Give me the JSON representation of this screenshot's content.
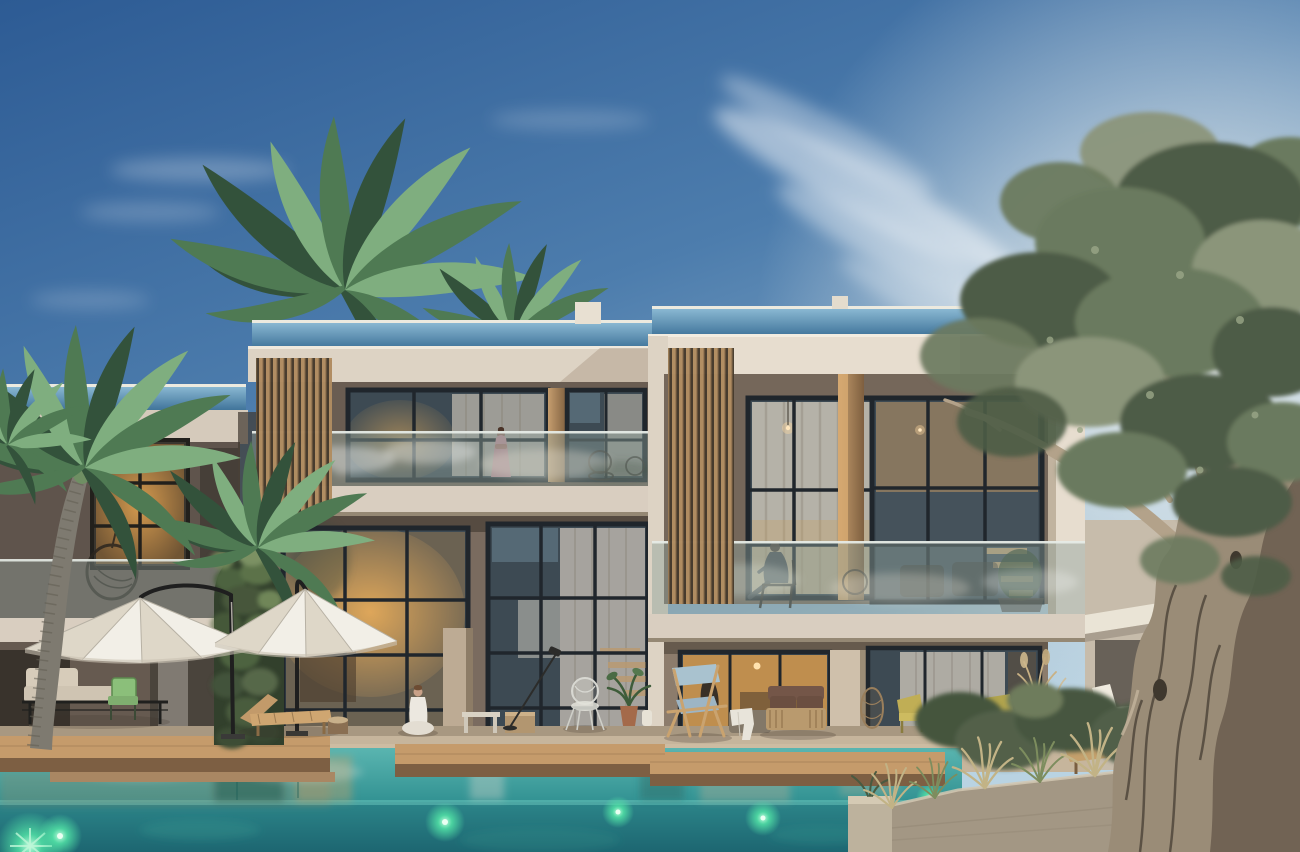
{
  "scene": {
    "type": "architectural-exterior-render",
    "time_of_day": "dusk",
    "description": "Twilight 3D rendering of a modern two-storey residential complex with cream fascia frames, wood-slat screens, glass balcony balustrades and large black-framed windows glowing warm inside; palm trees and an old olive tree flank the building; a wooden pool deck with white cantilever umbrellas, loungers and seated figures fronts an infinity pool with green underwater lights."
  },
  "palette": {
    "sky_top": "#2d5b94",
    "sky_mid": "#5585b4",
    "sky_low": "#aac7d9",
    "sun_glow": "#f5f6f3",
    "cloud": "#ffffff",
    "fascia": "#ddd3c4",
    "fascia_bright": "#e7ddcf",
    "soffit": "#9a8b7a",
    "slab": "#d9cec0",
    "wall_upper": "#6a5d52",
    "wall_upper_right": "#75675a",
    "wall_ground": "#7a6b5f",
    "wall_ground_right": "#8c7c6c",
    "slat_wood": "#b28e62",
    "slat_gap": "#463a2c",
    "fin_light": "#c59d6e",
    "fin_dark": "#7e5f3f",
    "window_frame": "#262c33",
    "glass_dark": "#3d4a53",
    "glass_warm": "#e2a352",
    "curtain": "#bdb8af",
    "balcony_glass": "#93a6a0",
    "roof_glass_top": "#8cbad4",
    "roof_glass_bottom": "#40749a",
    "deck_wood": "#c59b6b",
    "deck_face": "#7d5f43",
    "terrace": "#c6b59c",
    "pool_surface": "#4faaa6",
    "pool_mid": "#2f8f90",
    "pool_deep": "#1d6671",
    "pool_light_green": "#54e8a8",
    "palm_dark": "#33523b",
    "palm_mid": "#4f7a53",
    "palm_light": "#7fae7f",
    "palm_trunk": "#7e7a70",
    "ivy_dark": "#34432d",
    "ivy_mid": "#4d6340",
    "ivy_light": "#6f8659",
    "olive_dark": "#4e5c46",
    "olive_mid": "#6b7a5e",
    "olive_light": "#8b957a",
    "olive_branch": "#b3a28a",
    "olive_trunk": "#9a8c77",
    "olive_trunk_shadow": "#6a5c4d",
    "umbrella": "#f2efe7",
    "umbrella_shade": "#ded7c8",
    "umbrella_arm": "#1f1f1f",
    "sofa_cushion": "#cfc4b2",
    "green_chair": "#7fae6f",
    "lounger_wood": "#c29a6a",
    "cushion_white": "#eceadd",
    "blue_deckchair": "#a9c2cf",
    "loveseat_brown": "#6b4f41",
    "towel": "#e8e4da",
    "lantern_rattan": "#9a7f5c",
    "yellow_chair": "#c0ae55",
    "stone_planter": "#a39784",
    "grass_dry": "#c2b386",
    "grass_green": "#7d8d5e",
    "bush": "#45543e",
    "skin": "#c9a188",
    "dress_mauve": "#b58791",
    "white_clothes": "#ece8e0",
    "silhouette": "#3a3f46"
  },
  "elements": {
    "buildings": {
      "main_units": 2,
      "storeys": 2,
      "features": [
        "rooftop glass railing",
        "wood slat screens",
        "wood fin columns",
        "glass balcony balustrades",
        "floor-to-ceiling black framed windows",
        "warm interior lighting"
      ]
    },
    "vegetation": {
      "palm_trees": 4,
      "ivy_column": 1,
      "olive_tree": 1,
      "planter_grasses_and_bushes": true
    },
    "pool": {
      "type": "infinity pool",
      "underwater_lights": 5,
      "wooden_deck_platforms": 3
    },
    "furniture": [
      "white cantilever umbrella",
      "white cantilever umbrella",
      "beige daybed sofa",
      "green chair",
      "wooden sun lounger",
      "tree-stump side table",
      "white bench",
      "wooden cube stool",
      "arc floor lamp",
      "white wire chair",
      "potted plant",
      "blue director deck chair",
      "ottoman with towel",
      "brown wood-frame loveseat",
      "rattan lantern",
      "two olive-yellow chairs",
      "dried-flower vases",
      "white-cushion lounger",
      "wooden chaise with wheels"
    ],
    "people": [
      {
        "pose": "standing",
        "location": "upper-left balcony",
        "clothing": "mauve dress"
      },
      {
        "pose": "seated on chair",
        "location": "upper-right balcony",
        "clothing": "dark outfit"
      },
      {
        "pose": "seated cross-legged",
        "location": "pool deck",
        "clothing": "white outfit"
      },
      {
        "pose": "seated silhouette",
        "location": "ground-floor interior"
      }
    ],
    "lighting": [
      "dusk sky with sun glow behind clouds on right",
      "warm interior glow in windows",
      "green underwater pool lights"
    ]
  }
}
